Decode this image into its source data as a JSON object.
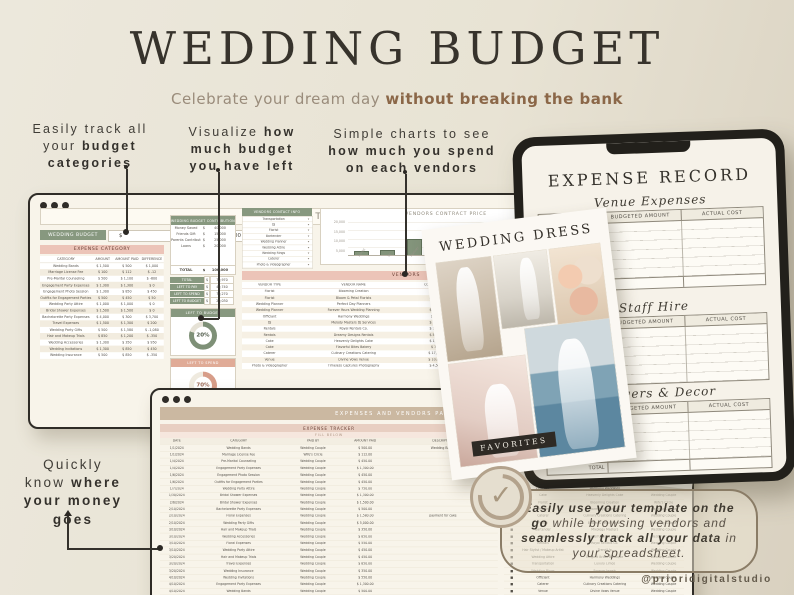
{
  "colors": {
    "accent_green": "#87987f",
    "accent_pink": "#ecc4b8",
    "tan_band": "#cbb8a1",
    "brown_bold": "#8b6748",
    "donut_green": "#7e9077",
    "donut_pink": "#d79d89",
    "dark_border": "#2f2c27"
  },
  "header": {
    "title": "WEDDING BUDGET",
    "subtitle_normal": "Celebrate your dream day ",
    "subtitle_bold": "without breaking the bank"
  },
  "annotations": {
    "a1": {
      "l1": "Easily track all",
      "l2n": "your ",
      "l2b": "budget",
      "l3b": "categories"
    },
    "a2": {
      "l1n": "Visualize ",
      "l1b": "how",
      "l2b": "much budget",
      "l3b": "you have left"
    },
    "a3": {
      "l1": "Simple charts to see",
      "l2b": "how much you spend",
      "l3b": "on each vendors"
    },
    "money": {
      "l1": "Quickly",
      "l2n": "know ",
      "l2b": "where",
      "l3b": "your money",
      "l4b": "goes"
    }
  },
  "budget_sheet": {
    "title": "BUDGET",
    "budget_label": "WEDDING BUDGET",
    "budget_currency": "$",
    "budget_value": "100,000",
    "expense_section": "EXPENSE CATEGORY",
    "expense_headers": [
      "CATEGORY",
      "AMOUNT",
      "AMOUNT PAID",
      "DIFFERENCE"
    ],
    "expense_rows": [
      [
        "Wedding Bands",
        "$ 1,500",
        "$ 500",
        "$ 1,000"
      ],
      [
        "Marriage License Fee",
        "$ 100",
        "$ 112",
        "$ -12"
      ],
      [
        "Pre-Marital Counseling",
        "$ 500",
        "$ 1,100",
        "$ -600"
      ],
      [
        "Engagement Party Expenses",
        "$ 1,300",
        "$ 1,300",
        "$ 0"
      ],
      [
        "Engagement Photo Session",
        "$ 1,300",
        "$ 850",
        "$ 450"
      ],
      [
        "Outfits for Engagement Parties",
        "$ 500",
        "$ 450",
        "$ 50"
      ],
      [
        "Wedding Party Attire",
        "$ 1,000",
        "$ 1,000",
        "$ 0"
      ],
      [
        "Bridal Shower Expenses",
        "$ 1,500",
        "$ 1,500",
        "$ 0"
      ],
      [
        "Bachelorette Party Expenses",
        "$ 4,000",
        "$ 300",
        "$ 3,700"
      ],
      [
        "Travel Expenses",
        "$ 1,500",
        "$ 1,300",
        "$ 200"
      ],
      [
        "Wedding Party Gifts",
        "$ 500",
        "$ 1,580",
        "$ -1,080"
      ],
      [
        "Hair and Makeup Trials",
        "$ 850",
        "$ 1,200",
        "$ -350"
      ],
      [
        "Wedding Accessories",
        "$ 1,300",
        "$ 350",
        "$ 950"
      ],
      [
        "Wedding Invitations",
        "$ 1,300",
        "$ 850",
        "$ 450"
      ],
      [
        "Wedding Insurance",
        "$ 500",
        "$ 850",
        "$ -350"
      ]
    ],
    "contribution": {
      "title": "WEDDING BUDGET CONTRIBUTION",
      "rows": [
        [
          "Money Saved",
          "$",
          "40,000"
        ],
        [
          "Friends Gift",
          "$",
          "15,000"
        ],
        [
          "Parents Contribution",
          "$",
          "25,000"
        ],
        [
          "Loans",
          "$",
          "20,000"
        ]
      ],
      "total_label": "TOTAL",
      "total_currency": "$",
      "total_value": "100,000"
    },
    "summary_rows": [
      [
        "TOTAL",
        "$",
        "79,970"
      ],
      [
        "LEFT TO PAY",
        "$",
        "49,740"
      ],
      [
        "LEFT TO SPEND",
        "$",
        "70,270"
      ],
      [
        "LEFT TO BUDGET",
        "$",
        "20,030"
      ]
    ],
    "gauge_budget": {
      "title": "LEFT TO BUDGET",
      "pct": "20%"
    },
    "gauge_spend": {
      "title": "LEFT TO SPEND",
      "pct": "70%"
    },
    "contacts": {
      "title": "VENDORS CONTACT INFO",
      "items": [
        [
          "Transportation",
          "▾"
        ],
        [
          "DJ",
          "▾"
        ],
        [
          "Florist",
          "▾"
        ],
        [
          "Bartender",
          "▾"
        ],
        [
          "Wedding Planner",
          "▾"
        ],
        [
          "Wedding Attire",
          "▾"
        ],
        [
          "Wedding Rings",
          "▾"
        ],
        [
          "Caterer",
          "▾"
        ],
        [
          "Photo & Videographer",
          "▾"
        ]
      ]
    },
    "vendors_section": "VENDORS",
    "vendors_headers": [
      "VENDOR TYPE",
      "VENDOR NAME",
      "CONTRACT PRICE",
      "AMOUNT PAID",
      "DIFFERENCE"
    ],
    "vendors_rows": [
      [
        "Florist",
        "Blooming Creation",
        "$ 1,500.00",
        "$ 0.00",
        "$ 1,500.00"
      ],
      [
        "Florist",
        "Bloom & Petal Florists",
        "$ 1,200.00",
        "$ 1,200.00",
        "$ 0.00"
      ],
      [
        "Wedding Planner",
        "Perfect Day Planners",
        "$ 0.00",
        "$ 0.00",
        "$ 0.00"
      ],
      [
        "Wedding Planner",
        "Forever Yours Wedding Planning",
        "$ 8,000.00",
        "$ 12,000.00",
        "$ -4,000.00"
      ],
      [
        "Officiant",
        "Harmony Weddings",
        "$ 450.00",
        "$ 450.00",
        "$ 0.00"
      ],
      [
        "DJ",
        "Melody Masters DJ Services",
        "$ 1,200.00",
        "$ 1,200.00",
        "$ 0.00"
      ],
      [
        "Rentals",
        "Royal Rentals Co.",
        "$ 1,500.00",
        "$ 0.00",
        "$ 1,500.00"
      ],
      [
        "Rentals",
        "Dreamy Designs Rentals",
        "$ 5,800.00",
        "$ 2,500.00",
        "$ 3,300.00"
      ],
      [
        "Cake",
        "Heavenly Delights Cake",
        "$ 1,500.00",
        "$ 1,450.00",
        "$ 50.00"
      ],
      [
        "Cake",
        "Flavorful Bites Bakery",
        "$ 750.00",
        "$ 750.00",
        "$ 0.00"
      ],
      [
        "Caterer",
        "Culinary Creations Catering",
        "$ 17,500.00",
        "$ 1,200.00",
        "$ 16,300.00"
      ],
      [
        "Venue",
        "Divine Vows Venue",
        "$ 10,000.00",
        "$ 0.00",
        "$ 10,000.00"
      ],
      [
        "Photo & Videographer",
        "Timeless Captures Photography",
        "$ 4,500.00",
        "$ 0.00",
        "$ 4,500.00"
      ]
    ]
  },
  "chart_data": {
    "type": "bar",
    "title": "VENDORS CONTRACT PRICE",
    "categories": [
      "Florist",
      "DJ",
      "Planner",
      "Officiant",
      "Caterer",
      "Cake",
      "Rentals",
      "Venue"
    ],
    "values": [
      1500,
      2400,
      9000,
      1800,
      14400,
      450,
      2250,
      18400
    ],
    "ymax": 20000,
    "ylim": [
      0,
      20000
    ],
    "yticks": [
      "20,000",
      "15,000",
      "10,000",
      "5,000"
    ],
    "xlabel": "",
    "ylabel": "",
    "grid": "on",
    "legend": "none"
  },
  "tracker_sheet": {
    "title": "EXPENSES AND VENDORS PAYMENT TRACKER",
    "left": {
      "title": "EXPENSE TRACKER",
      "fill": "FILL BELOW",
      "headers": [
        "DATE",
        "CATEGORY",
        "PAID BY",
        "AMOUNT PAID",
        "DESCRIPTION"
      ],
      "rows": [
        [
          "1/1/2024",
          "Wedding Bands",
          "Wedding Couple",
          "$ 500.00",
          "Wedding Bands"
        ],
        [
          "1/1/2024",
          "Marriage License Fee",
          "Wife's Circle",
          "$ 112.00",
          ""
        ],
        [
          "1/4/2024",
          "Pre-Marital Counseling",
          "Wedding Couple",
          "$ 450.00",
          ""
        ],
        [
          "1/4/2024",
          "Engagement Party Expenses",
          "Wedding Couple",
          "$ 1,300.00",
          ""
        ],
        [
          "1/6/2024",
          "Engagement Photo Session",
          "Wedding Couple",
          "$ 450.00",
          ""
        ],
        [
          "1/6/2024",
          "Outfits for Engagement Parties",
          "Wedding Couple",
          "$ 450.00",
          ""
        ],
        [
          "1/7/2024",
          "Wedding Party Attire",
          "Wedding Couple",
          "$ 750.00",
          ""
        ],
        [
          "1/30/2024",
          "Bridal Shower Expenses",
          "Wedding Couple",
          "$ 1,300.00",
          ""
        ],
        [
          "2/6/2024",
          "Bridal Shower Expenses",
          "Wedding Couple",
          "$ 1,500.00",
          ""
        ],
        [
          "2/10/2024",
          "Bachelorette Party Expenses",
          "Wedding Couple",
          "$ 500.00",
          ""
        ],
        [
          "2/10/2024",
          "Floral Expenses",
          "Wedding Couple",
          "$ 1,580.00",
          "payment for cake"
        ],
        [
          "2/10/2024",
          "Wedding Party Gifts",
          "Wedding Couple",
          "$ 5,000.00",
          ""
        ],
        [
          "3/10/2024",
          "Hair and Makeup Trials",
          "Wedding Couple",
          "$ 350.00",
          ""
        ],
        [
          "3/10/2024",
          "Wedding Accessories",
          "Wedding Couple",
          "$ 850.00",
          ""
        ],
        [
          "3/10/2024",
          "Floral Expenses",
          "Wedding Couple",
          "$ 550.00",
          ""
        ],
        [
          "3/10/2024",
          "Wedding Party Attire",
          "Wedding Couple",
          "$ 450.00",
          ""
        ],
        [
          "3/20/2024",
          "Hair and Makeup Trials",
          "Wedding Couple",
          "$ 450.00",
          ""
        ],
        [
          "3/20/2024",
          "Travel Expenses",
          "Wedding Couple",
          "$ 850.00",
          ""
        ],
        [
          "3/20/2024",
          "Wedding Insurance",
          "Wedding Couple",
          "$ 350.00",
          ""
        ],
        [
          "4/10/2024",
          "Wedding Invitations",
          "Wedding Couple",
          "$ 550.00",
          ""
        ],
        [
          "4/10/2024",
          "Engagement Party Expenses",
          "Wedding Couple",
          "$ 1,300.00",
          ""
        ],
        [
          "4/10/2024",
          "Wedding Bands",
          "Wedding Couple",
          "$ 500.00",
          ""
        ]
      ]
    },
    "right": {
      "title": "VENDORS PAYMENT TRACKER",
      "fill": "FILL BELOW",
      "headers": [
        "PAID",
        "VENDOR TYPE",
        "VENDOR NAME",
        "PAID BY"
      ],
      "rows": [
        [
          "■",
          "Venue",
          "Divine Vows Venue",
          "Wedding Couple"
        ],
        [
          "■",
          "Wedding Planner",
          "Forever Yours Wedding Planning",
          "Wedding Couple"
        ],
        [
          "■",
          "Photo & Videographer",
          "Timeless Captures Photography",
          "Wedding Couple"
        ],
        [
          "■",
          "DJ",
          "Melody Masters DJ Services",
          "Wedding Couple"
        ],
        [
          "■",
          "Caterer",
          "Culinary Creations Catering",
          "Wedding Couple"
        ],
        [
          "□",
          "Rentals",
          "Dreamy Designs Rentals",
          ""
        ],
        [
          "□",
          "Officiant",
          "Harmony Weddings",
          ""
        ],
        [
          "■",
          "Cake",
          "Heavenly Delights Cake",
          "Wedding Couple"
        ],
        [
          "■",
          "Florist",
          "Blooming Creation",
          "Wife's Circle"
        ],
        [
          "■",
          "Officiant",
          "Harmony Weddings",
          "Wedding Couple"
        ],
        [
          "■",
          "Caterer",
          "Culinary Creations Catering",
          "Wedding Couple"
        ],
        [
          "■",
          "Florist",
          "Bloom & Petal Florists",
          "Wedding Couple"
        ],
        [
          "■",
          "Bartender",
          "Mixology Masters",
          "Wedding Couple"
        ],
        [
          "■",
          "Cake",
          "Flavorful Bites Bakery",
          "Wedding Couple"
        ],
        [
          "■",
          "Rentals",
          "Royal Rentals Co.",
          "Wedding Couple"
        ],
        [
          "■",
          "Hair Stylist / Makeup Artist",
          "Trend Up",
          "Wedding Couple"
        ],
        [
          "■",
          "Wedding Attire",
          "Elegant Bridal Boutique",
          "Wedding Couple"
        ],
        [
          "■",
          "Transportation",
          "Luxury Limos",
          "Wedding Couple"
        ],
        [
          "■",
          "Wedding Rings",
          "Forever Jewels",
          "Wedding Couple"
        ],
        [
          "■",
          "Officiant",
          "Harmony Weddings",
          "Wedding Couple"
        ],
        [
          "■",
          "Caterer",
          "Culinary Creations Catering",
          "Wedding Couple"
        ],
        [
          "■",
          "Venue",
          "Divine Vows Venue",
          "Wedding Couple"
        ]
      ]
    }
  },
  "tablet": {
    "title": "EXPENSE RECORD",
    "sections": [
      {
        "heading": "Venue Expenses",
        "col1": "BUDGETED AMOUNT",
        "col2": "ACTUAL COST",
        "total": "TOTAL"
      },
      {
        "heading": "Staff Hire",
        "col1": "BUDGETED AMOUNT",
        "col2": "ACTUAL COST",
        "total": ""
      },
      {
        "heading": "Flowers & Decor",
        "col1": "BUDGETED AMOUNT",
        "col2": "ACTUAL COST",
        "total": "TOTAL"
      }
    ]
  },
  "moodboard": {
    "title": "WEDDING DRESS",
    "badge": "FAVORITES"
  },
  "callout": {
    "b1": "Easily use your template on the go",
    "n1": " while browsing vendors and ",
    "b2": "seamlessly track all your data",
    "n2": " in your spreadsheet."
  },
  "footer": {
    "handle": "@prioridigitalstudio"
  }
}
